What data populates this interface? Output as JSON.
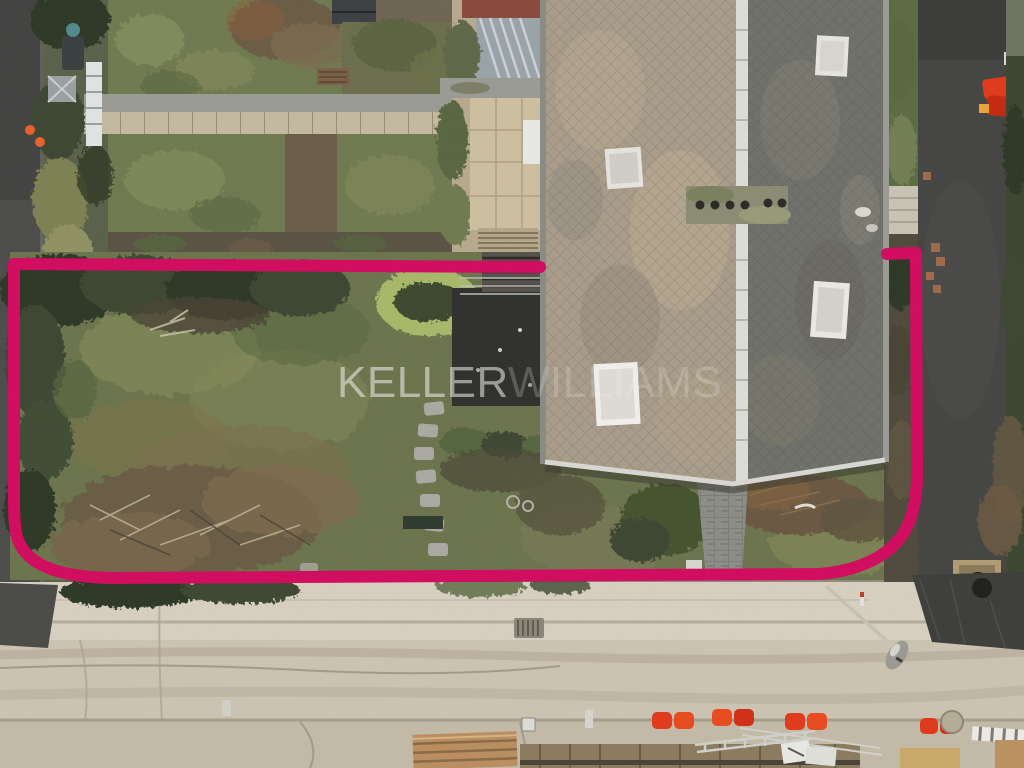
{
  "watermark": {
    "part1": "KELLER",
    "part2": "WILLIAMS",
    "color_primary": "rgba(242,242,240,0.55)",
    "color_secondary": "rgba(242,242,240,0.22)",
    "font_size": "44"
  },
  "boundary": {
    "color": "#d10b5e",
    "stroke_width": "12",
    "top_left_segment": "M 14 264 L 540 267",
    "top_right_segment": "M 887 254 L 916 253",
    "main_path": "M 916 253 L 917 468 C 918 515 905 538 886 552 C 868 565 845 572 820 574 L 112 578 C 60 577 28 566 18 540 C 14 528 14 512 14 496 L 14 264"
  },
  "palette": {
    "boundary_pink": "#d10b5e",
    "roof_left": "#a89b8a",
    "roof_right": "#70706a",
    "roof_ridge": "#dcdcd6",
    "lawn_green": "#6c744d",
    "hedge_dark": "#3c4731",
    "asphalt_left_road": "#4c4c4a",
    "asphalt_driveway": "#454543",
    "asphalt_patch": "#3d3d3b",
    "street_sand": "#cbc3b1",
    "sidewalk": "#d6cfc0",
    "path_paver": "#c3b99f",
    "terrace": "#cdbf9f",
    "barrier_red": "#e03a1a",
    "cone_orange": "#e8622a"
  }
}
